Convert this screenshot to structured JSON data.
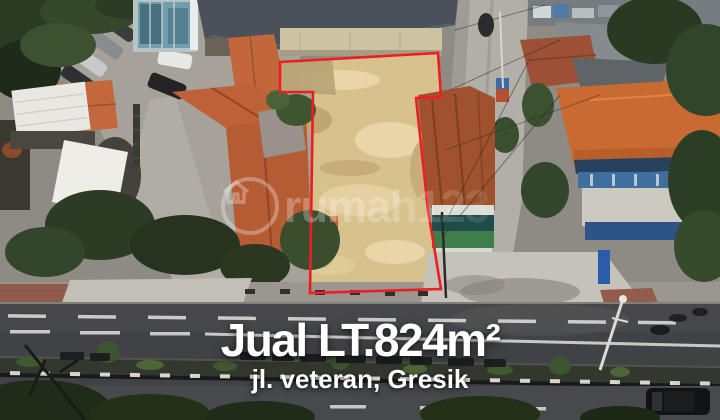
{
  "overlay": {
    "title": "Jual LT.824m²",
    "subtitle": "jl. veteran, Gresik"
  },
  "watermark": {
    "text": "rumah123",
    "icon": "house-in-circle-icon"
  },
  "colors": {
    "boundary_red": "#ee1d23",
    "caption_text": "#ffffff",
    "land_sand": "#d7c18d",
    "roof_orange": "#c2673c",
    "road_asphalt": "#404245"
  }
}
